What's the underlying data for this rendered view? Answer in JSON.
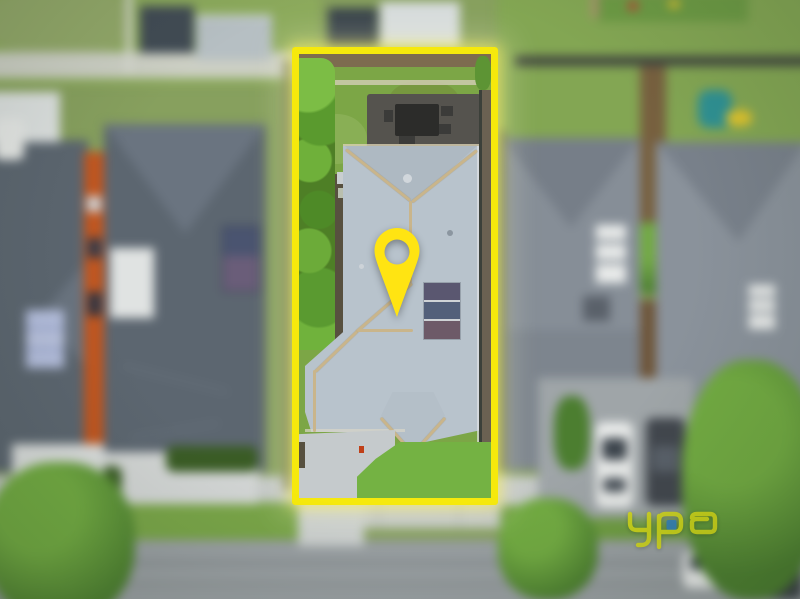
{
  "overlay": {
    "brand_logo": {
      "text": "ypa",
      "style": "outlined lowercase logotype",
      "color": "#d6db17",
      "accent_color": "#2f80c3"
    },
    "property_boundary": {
      "shape": "rectangle",
      "color": "#f6e90c"
    },
    "location_pin": {
      "icon": "map-pin",
      "color": "#ffe412"
    }
  },
  "scene": {
    "caption": "Blurred aerial drone photo of a suburban street. A bright yellow rectangle outlines the subject lot and a yellow map pin sits over its grey hip roof. Inside the lot: rear paling fence, backyard lawn, paved patio with outdoor table, hedge along the left boundary, grey corrugated roof with tan ridge capping and solar panels, concrete driveway and front lawn. Around it: neighbouring dark- and grey-roofed houses, rear-yard sheds, street trees, parked cars, footpath and road.",
    "subject_lot_features": [
      "rear paling fence",
      "backyard lawn",
      "paved patio with outdoor table and chairs",
      "hedge along left boundary",
      "grey corrugated hip roof with tan ridge capping",
      "rooftop solar panels",
      "concrete driveway",
      "front lawn"
    ],
    "surroundings": [
      "rear-yard sheds (top)",
      "dark-roofed neighbour house with orange side wall (left)",
      "grey-roofed neighbour houses with skylights (right)",
      "green street trees",
      "white and dark cars on right driveway",
      "white car parked on street",
      "footpath and road (bottom)"
    ]
  },
  "colors": {
    "boundary_yellow": "#f6e90c",
    "pin_yellow": "#ffe412",
    "logo_yellow": "#d6db17",
    "logo_blue": "#2f80c3",
    "grass": "#7ca646",
    "grass_bright": "#8fbc52",
    "grass_dark": "#5f8c36",
    "grass_muted": "#93a86d",
    "hedge": "#4e7f26",
    "hedge_bright": "#6aa835",
    "tree": "#4d8030",
    "tree_light": "#72ab42",
    "roof_subject": "#b8c3cc",
    "roof_subject_shade": "#aeb9c2",
    "ridge_tan": "#c9b58b",
    "roof_dark": "#5c6670",
    "roof_dark_light": "#6a7480",
    "roof_grey": "#868e97",
    "roof_grey_shade": "#767e88",
    "concrete": "#c8ccce",
    "sidewalk": "#c4c8c7",
    "street": "#9aa0a3",
    "patio": "#55534e",
    "furniture": "#2c2c2a",
    "fence_brown": "#77603f",
    "fence_dark": "#41463f",
    "soil": "#57503f",
    "orange_wall": "#c2561f",
    "solar": "#4e5a74",
    "panel_light": "#a9b3d4",
    "white": "#e9ebea",
    "car_dark": "#42474e"
  }
}
